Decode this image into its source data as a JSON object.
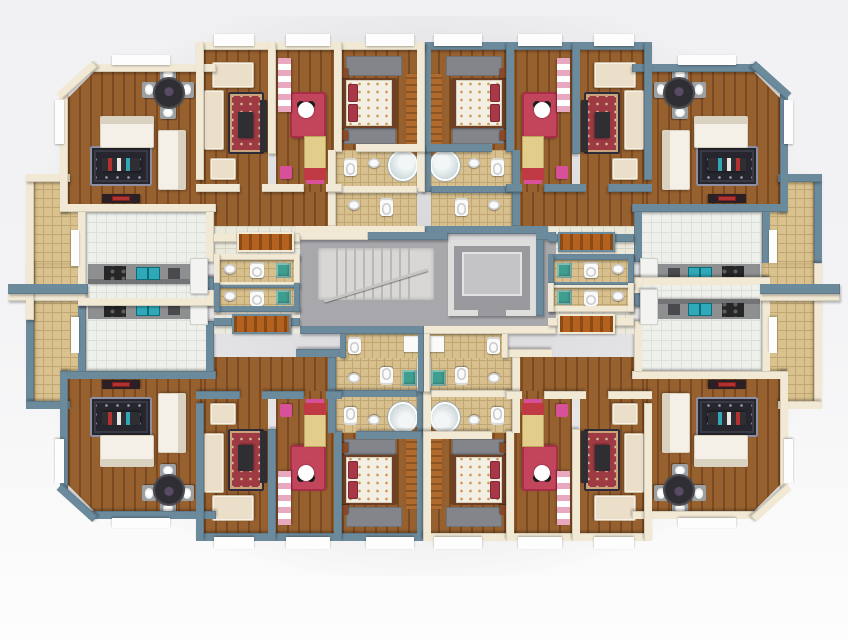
{
  "scene": {
    "type": "3d-architectural-floor-plan-render",
    "view": "top-down dollhouse view",
    "description": "Rendered residential floor plate with four mirrored apartments arranged around a central core with staircase and elevator; no text labels are visible in the image",
    "apartment_count": 4,
    "symmetry": "left-right and top-bottom mirrored"
  },
  "palette": {
    "bg_top": "#f1f1f3",
    "bg_mid": "#f3f3f5",
    "bg_bottom": "#fdfdfd",
    "cream_wall": "#f1e9d4",
    "blue_wall": "#6b8a9c",
    "sill_white": "#fdfdfd",
    "wood_light": "#96602f",
    "wood_dark": "#7c4a22",
    "tile_bath": "#d7bf8e",
    "tile_grid": "#bfa673",
    "tile_terrace": "#dac28e",
    "terrace_grid": "#c0a672",
    "tile_plaza": "#ebe8dc",
    "plaza_grid": "#d9d5c5",
    "tile_kitchen": "#eef0ec",
    "kitchen_grid": "#dde0da",
    "corridor_gray": "#a8a8ac",
    "stair_light": "#d8d7d5",
    "stair_tread": "#b9b8b6",
    "elevator_wall": "#dededc",
    "elevator_shaft": "#9a9a9e",
    "elevator_cab": "#c4c4c6",
    "counter_gray": "#8e8f91",
    "counter_edge": "#737476",
    "stove_black": "#262626",
    "sink_teal": "#2fa9b9",
    "fridge_white": "#f3f3f1",
    "sofa_white": "#f4f0e7",
    "sofa_shadow": "#d9d2c0",
    "sofa_cream": "#ecdfc9",
    "rug_dark": "#26262e",
    "rug_dark_inner": "#3a3a46",
    "rug_dark_accent": "#9a9ab8",
    "rug_red": "#9e3a44",
    "rug_red_border": "#2c2c3a",
    "rug_red_accent": "#d8b890",
    "rug_gray": "#84858a",
    "rug_minnie": "#c2455c",
    "minnie_white": "#ffffff",
    "minnie_black": "#1a1a1a",
    "bed_white": "#f4efe4",
    "bed_floral": "#c9a05a",
    "pillow_red": "#a83848",
    "bed_frame": "#6e3f22",
    "nightstand": "#8a4a26",
    "kid_bed_yellow": "#e2cd8d",
    "kid_pillow_red": "#c03a44",
    "kid_blanket_pink": "#d8509a",
    "kid_wardrobe_pink": "#e8a8c0",
    "wardrobe_orange": "#b06a2e",
    "wardrobe_orange_dark": "#8d5423",
    "door_brown": "#b4611f",
    "door_brown_dark": "#8a4a16",
    "porcelain": "#fafafa",
    "fixture_shadow": "#c9c9c9",
    "washer_teal": "#3f9e8f",
    "table_dark": "#2e2e33",
    "chair_gray": "#9aa0a4",
    "tv_red": "#b23232",
    "glass": "#cdd9dc"
  },
  "building": {
    "unit_rooms": [
      {
        "id": "living-dining-room",
        "floor": "wood planks",
        "furniture": [
          "white sofa set",
          "dark ornate rug",
          "coffee table",
          "dining table with four chairs and place settings",
          "red tv bench"
        ]
      },
      {
        "id": "salon",
        "floor": "wood planks",
        "furniture": [
          "cream sofa set",
          "red ornate rug",
          "dark coffee table",
          "tv unit"
        ]
      },
      {
        "id": "kids-bedroom",
        "floor": "wood planks",
        "furniture": [
          "minnie-mouse rug",
          "single bed with red pillow",
          "pink-white wardrobe",
          "small chair"
        ]
      },
      {
        "id": "master-bedroom",
        "floor": "wood planks",
        "furniture": [
          "double bed with floral cover and red pillows",
          "two gray rugs",
          "nightstands",
          "orange wardrobe"
        ]
      },
      {
        "id": "bathroom",
        "floor": "beige tile",
        "furniture": [
          "toilet",
          "round glass shower",
          "pedestal sink"
        ]
      },
      {
        "id": "kitchen",
        "floor": "light tile",
        "furniture": [
          "gray counter",
          "black four-burner stove",
          "teal double sink",
          "fridge"
        ]
      },
      {
        "id": "entrance-hall",
        "floor": "light tile",
        "furniture": [
          "entry door",
          "guest wc with toilet, sink and teal unit"
        ]
      },
      {
        "id": "balcony-terrace",
        "floor": "beige tile grid",
        "furniture": []
      }
    ],
    "apartments": [
      {
        "slot": "q-tl",
        "name": "apartment-top-left",
        "wall_theme": "cream"
      },
      {
        "slot": "q-tr",
        "name": "apartment-top-right",
        "wall_theme": "blue"
      },
      {
        "slot": "q-bl",
        "name": "apartment-bottom-left",
        "wall_theme": "blue"
      },
      {
        "slot": "q-br",
        "name": "apartment-bottom-right",
        "wall_theme": "cream"
      }
    ],
    "core": {
      "corridor": "gray landing connecting all four apartment entry doors",
      "staircase": "u-shaped stair with treads and diagonal railing, left of center",
      "elevator": "enclosed shaft with cab, right of center",
      "entry_doors": 4,
      "guest_wc_blocks": 2
    }
  }
}
